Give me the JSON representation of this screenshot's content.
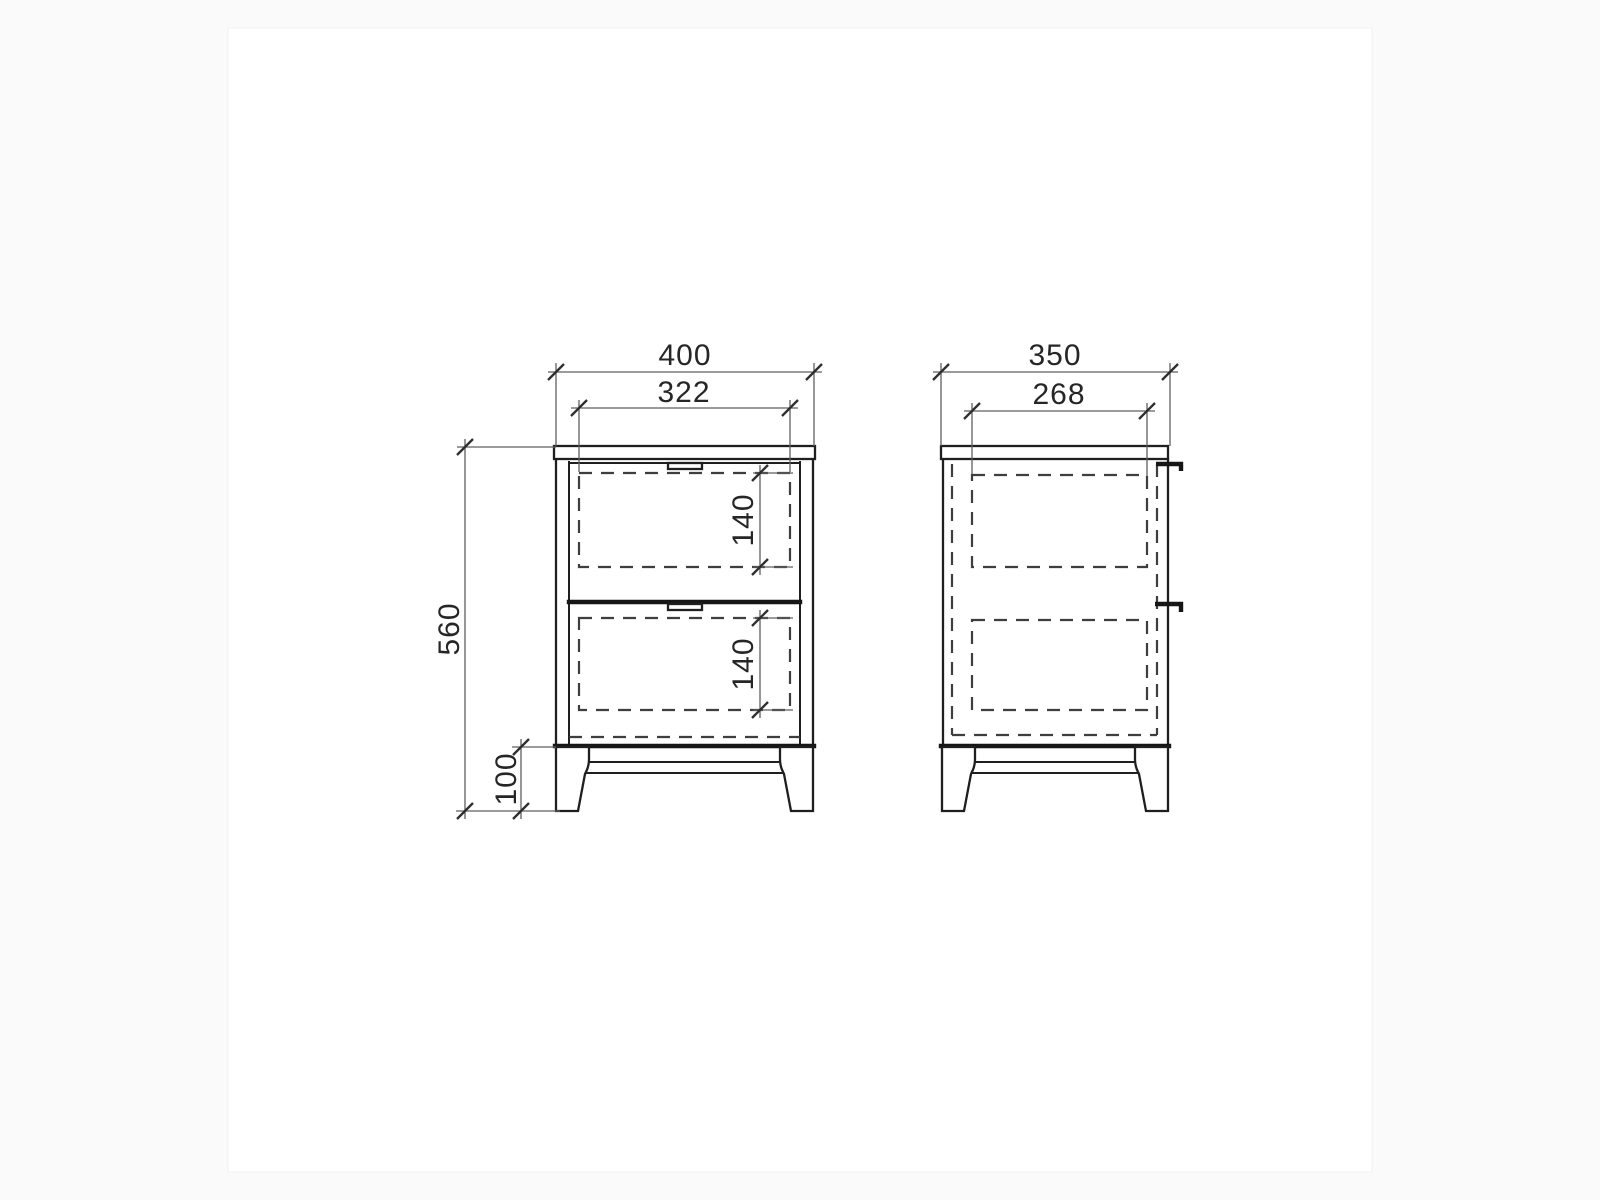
{
  "diagram": {
    "kind": "furniture-dimension-drawing",
    "subject": "two-drawer bedside cabinet, orthographic front and side views",
    "front_view": {
      "name": "front-view",
      "dims": {
        "overall_width": "400",
        "inner_width": "322",
        "overall_height": "560",
        "leg_height": "100",
        "upper_drawer_height": "140",
        "lower_drawer_height": "140"
      }
    },
    "side_view": {
      "name": "side-view",
      "dims": {
        "overall_depth": "350",
        "inner_depth": "268"
      }
    },
    "colors": {
      "solid_line": "#1f1f1f",
      "heavy_line": "#161616",
      "hidden_dashed_line": "#3e3e3e",
      "dimension_line": "#5f5f5f",
      "text": "#262626",
      "sheet": "#ffffff",
      "background": "#fafafa"
    }
  }
}
